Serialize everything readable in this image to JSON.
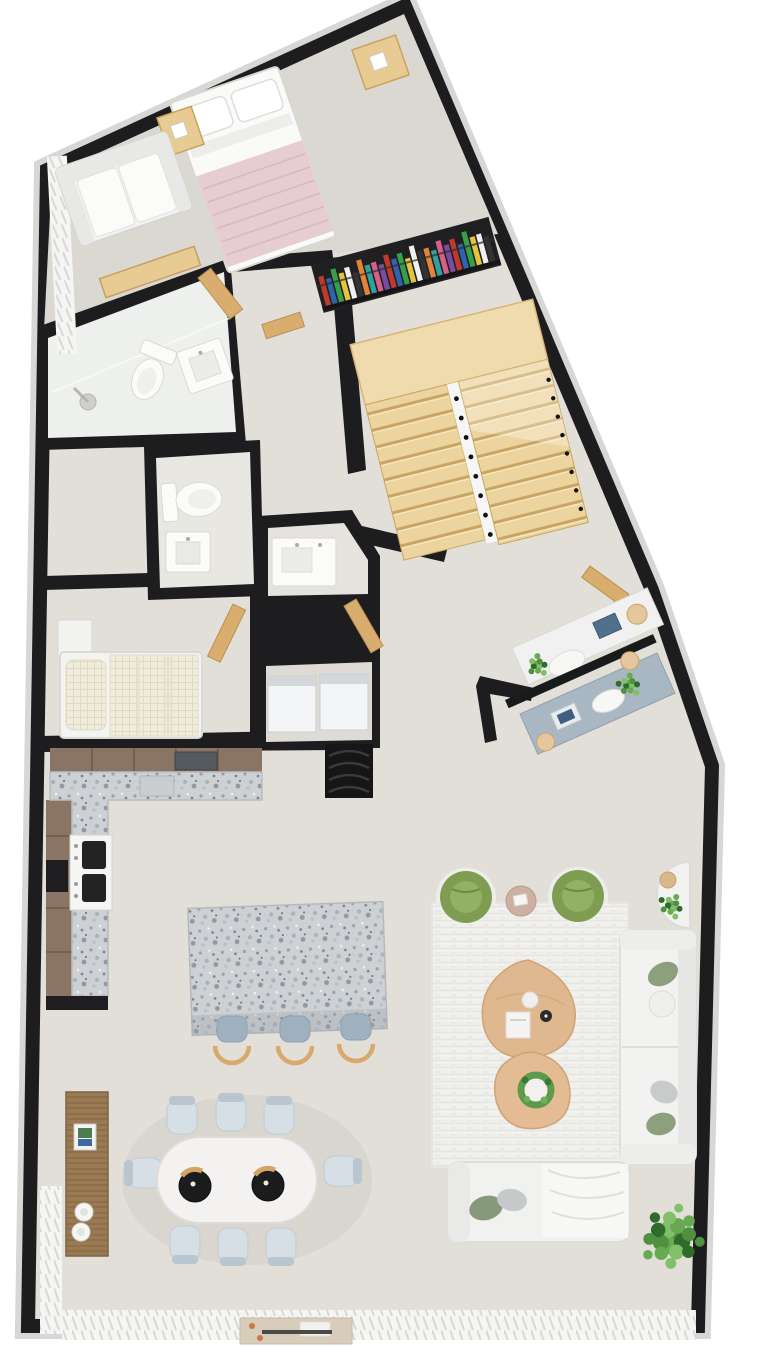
{
  "meta": {
    "kind": "3d-rendered-floor-plan",
    "view": "top-down",
    "text_visible": "none"
  },
  "colors": {
    "bg": "#ffffff",
    "trim": "#e2e2e0",
    "wall": "#1d1d1f",
    "floor": "#e2dfd9",
    "floorBedroom": "#dbd8d2",
    "tile": "#eef0ee",
    "tileGray": "#e9e7e2",
    "wood": "#e7cb92",
    "woodDark": "#cfa567",
    "stairWood": "#ecd49e",
    "doorWood": "#d9ad6e",
    "cabinet": "#8a7463",
    "cabinetLine": "#6e5a49",
    "granite": "#ced1d3",
    "white": "#f4f4f2",
    "pink": "#e5cdd1",
    "pinkLine": "#d8b9bf",
    "green": "#7f9d51",
    "greenInner": "#93b162",
    "plantPot": "#6b675f",
    "stoolSeat": "#9fb1bf",
    "stoolWood": "#d9a86c",
    "chair": "#d6dfe5",
    "chairBack": "#b9c6cf",
    "lamp": "#1b1c1e",
    "lampWood": "#d2a567",
    "deskBlue": "#a9b7c3",
    "laptopBlue": "#51708e",
    "applianceWhite": "#f4f5f6",
    "dark": "#161616",
    "rug": "#f1f0ed",
    "pebbleWood": "#e0b88f",
    "sofaPillowGreen": "#8ca07e",
    "sofaPillowGray": "#c8cbcc"
  },
  "book_palette": [
    "#c0392b",
    "#2e63ad",
    "#35a04a",
    "#e3c43c",
    "#f0f0ee",
    "#333333",
    "#e2833a",
    "#2fa39b",
    "#d85f8c",
    "#7a4ca0"
  ],
  "book_heights": [
    30,
    26,
    34,
    28,
    32,
    25,
    36,
    29
  ],
  "bookshelf": {
    "books": 26
  },
  "stairs": {
    "flights": 2,
    "balusters": 8,
    "landing": true
  },
  "plant_palette": [
    "#2f6b2a",
    "#4f9140",
    "#67aa52",
    "#82bf6a"
  ],
  "rooms": [
    {
      "name": "master-bedroom",
      "furniture": [
        "double-bed",
        "pink-blanket",
        "pillows",
        "nightstand-left",
        "nightstand-right",
        "loveseat",
        "wood-bench",
        "sheer-curtain"
      ]
    },
    {
      "name": "bathroom-main",
      "furniture": [
        "shower-head",
        "toilet",
        "vanity-sink",
        "glass-divider",
        "wood-door"
      ]
    },
    {
      "name": "stair-hall",
      "furniture": [
        "bookshelf-colorful-books",
        "u-shaped-wood-staircase"
      ]
    },
    {
      "name": "wc",
      "furniture": [
        "toilet",
        "sink-cabinet"
      ]
    },
    {
      "name": "bathroom-2",
      "furniture": [
        "vanity-sink",
        "wood-door"
      ]
    },
    {
      "name": "laundry-closet",
      "furniture": [
        "washer",
        "dryer",
        "dark-ribbed-unit"
      ]
    },
    {
      "name": "bedroom-2",
      "furniture": [
        "single-bed",
        "checkered-blanket",
        "dresser",
        "wood-door"
      ]
    },
    {
      "name": "study-nook",
      "furniture": [
        "white-desk",
        "blue-desk",
        "laptops",
        "oval-chairs",
        "stools",
        "plants",
        "wood-door"
      ]
    },
    {
      "name": "kitchen",
      "furniture": [
        "l-shaped-granite-counter",
        "upper-cabinets",
        "range",
        "oven",
        "sink",
        "granite-island",
        "bar-stools-3"
      ]
    },
    {
      "name": "dining",
      "furniture": [
        "oval-table",
        "chairs-8",
        "pendant-lamps-2",
        "wood-sideboard",
        "framed-art",
        "plates",
        "doormat"
      ]
    },
    {
      "name": "living",
      "furniture": [
        "green-armchairs-2",
        "round-side-table",
        "half-round-console",
        "white-sofa",
        "pebble-coffee-tables-2",
        "area-rug",
        "daybed-with-throw",
        "potted-plant"
      ]
    }
  ],
  "counts": {
    "dining_chairs": 8,
    "bar_stools": 3,
    "pendant_lamps": 2,
    "green_armchairs": 2,
    "coffee_tables": 2,
    "appliances": 2
  }
}
